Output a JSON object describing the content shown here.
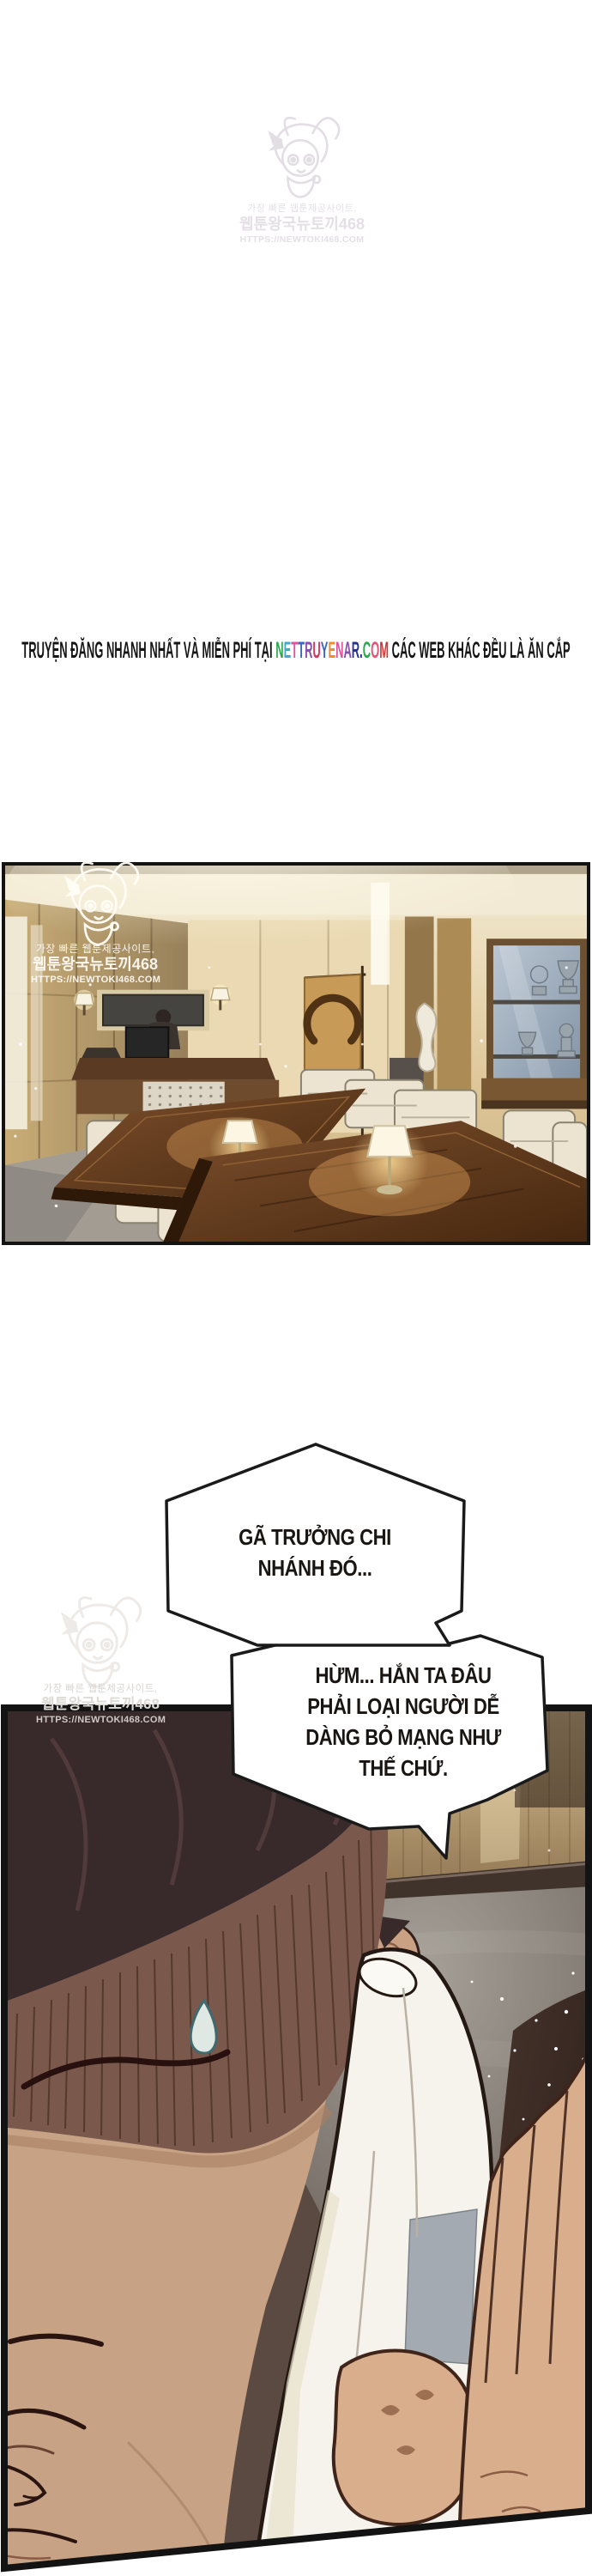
{
  "banner": {
    "prefix": "TRUYỆN ĐĂNG NHANH NHẤT VÀ MIỄN PHÍ TẠI ",
    "site_letters": [
      [
        "N",
        "#2ba84e"
      ],
      [
        "E",
        "#3fa9c9"
      ],
      [
        "T",
        "#e0519e"
      ],
      [
        "T",
        "#3a66c0"
      ],
      [
        "R",
        "#8a4fae"
      ],
      [
        "U",
        "#d13a63"
      ],
      [
        "Y",
        "#3a66c0"
      ],
      [
        "E",
        "#ef8c2f"
      ],
      [
        "N",
        "#e0519e"
      ],
      [
        "A",
        "#8a4fae"
      ],
      [
        "R",
        "#27348f"
      ],
      [
        ".",
        "#27348f"
      ],
      [
        "C",
        "#2ba84e"
      ],
      [
        "O",
        "#e25576"
      ],
      [
        "M",
        "#d23737"
      ]
    ],
    "suffix": " CÁC WEB KHÁC ĐỀU LÀ ĂN CẮP"
  },
  "watermark": {
    "line1": "가장 빠른 웹툰제공사이트,",
    "line2": "웹툰왕국뉴토끼468",
    "line3": "HTTPS://NEWTOKI468.COM"
  },
  "bubble1": {
    "lines": [
      "GÃ TRƯỞNG CHI",
      "NHÁNH ĐÓ..."
    ]
  },
  "bubble2": {
    "lines": [
      "HỪM... HẮN TA ĐÂU",
      "PHẢI LOẠI NGƯỜI DỄ",
      "DÀNG BỎ MẠNG NHƯ",
      "THẾ CHỨ."
    ]
  },
  "palette": {
    "page_bg": "#ffffff",
    "panel_border": "#131313",
    "bubble_fill": "#ffffff",
    "bubble_stroke": "#1a1a1a",
    "wood_table": "#5e3519",
    "sofa_cream": "#ece4d0",
    "hair_dark": "#38292b",
    "hair_brown": "#7a584c",
    "skin": "#c7a285",
    "gold_wall": "#b59565",
    "sweat_drop": "#3e6a70"
  }
}
